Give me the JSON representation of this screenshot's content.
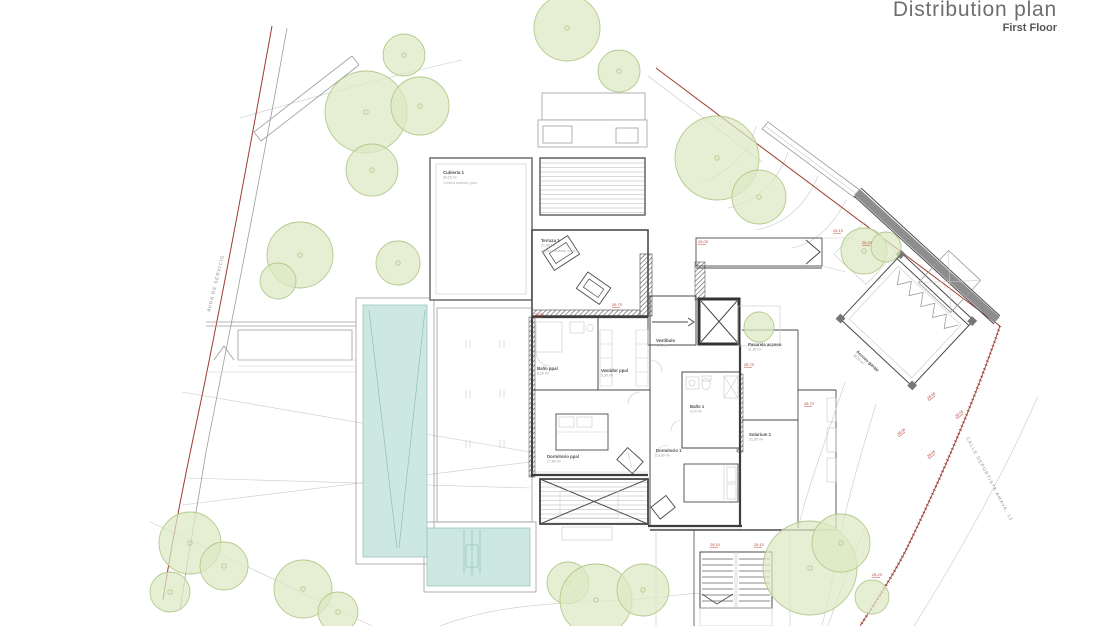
{
  "header": {
    "title": "Distribution plan",
    "subtitle": "First Floor"
  },
  "streets": {
    "left": "AVDA DE SERVICIO",
    "right": "CALLE DEPORTISTA AMAYA, 12"
  },
  "colors": {
    "pool": "#cde8e2",
    "pool_line": "#93bfb5",
    "tree_fill": "#dde9c3",
    "tree_stroke": "#b5c98b",
    "boundary_red": "#9c3b2e",
    "level_red": "#b5443a",
    "wall_dark": "#3d3d3d",
    "label": "#5a5a5a"
  },
  "rooms": [
    {
      "id": "cubierta",
      "name": "Cubierta 1",
      "area": "30,15 m²",
      "note": "Cubierta acabado grava",
      "x": 443,
      "y": 174
    },
    {
      "id": "terraza",
      "name": "Terraza 1",
      "area": "21,40 m²",
      "note": "Cubierta acabado madera",
      "x": 541,
      "y": 242
    },
    {
      "id": "banoppal",
      "name": "Baño ppal",
      "area": "6,20 m²",
      "x": 537,
      "y": 370
    },
    {
      "id": "vestidor",
      "name": "Vestidor ppal",
      "area": "5,30 m²",
      "x": 601,
      "y": 372
    },
    {
      "id": "vestibulo",
      "name": "Vestíbulo",
      "area": "4,90 m²",
      "x": 656,
      "y": 342
    },
    {
      "id": "dormppal",
      "name": "Dormitorio ppal",
      "area": "17,60 m²",
      "x": 547,
      "y": 458
    },
    {
      "id": "dorm1",
      "name": "Dormitorio 1",
      "area": "13,90 m²",
      "x": 656,
      "y": 452
    },
    {
      "id": "bano1",
      "name": "Baño 1",
      "area": "4,10 m²",
      "x": 690,
      "y": 408
    },
    {
      "id": "pasarela",
      "name": "Pasarela acceso",
      "area": "11,20 m²",
      "x": 748,
      "y": 346
    },
    {
      "id": "solarium",
      "name": "Solarium 1",
      "area": "21,30 m²",
      "x": 749,
      "y": 436
    },
    {
      "id": "garaje",
      "name": "Acceso garaje",
      "area": "36,50 m²",
      "x": 856,
      "y": 352,
      "rotate": 43
    }
  ],
  "levels": [
    {
      "value": "28.80",
      "x": 534,
      "y": 316
    },
    {
      "value": "28.75",
      "x": 612,
      "y": 306
    },
    {
      "value": "29.05",
      "x": 698,
      "y": 243
    },
    {
      "value": "29.15",
      "x": 833,
      "y": 232
    },
    {
      "value": "29.20",
      "x": 862,
      "y": 244
    },
    {
      "value": "28.75",
      "x": 744,
      "y": 366
    },
    {
      "value": "28.70",
      "x": 804,
      "y": 405
    },
    {
      "value": "28.60",
      "x": 928,
      "y": 400,
      "rotate": -38
    },
    {
      "value": "28.55",
      "x": 956,
      "y": 418,
      "rotate": -38
    },
    {
      "value": "28.50",
      "x": 898,
      "y": 436,
      "rotate": -38
    },
    {
      "value": "28.45",
      "x": 928,
      "y": 458,
      "rotate": -38
    },
    {
      "value": "29.10",
      "x": 710,
      "y": 546
    },
    {
      "value": "29.10",
      "x": 754,
      "y": 546
    },
    {
      "value": "28.25",
      "x": 872,
      "y": 576
    }
  ],
  "trees": [
    {
      "x": 404,
      "y": 55,
      "r": 21
    },
    {
      "x": 366,
      "y": 112,
      "r": 41
    },
    {
      "x": 420,
      "y": 106,
      "r": 29
    },
    {
      "x": 372,
      "y": 170,
      "r": 26
    },
    {
      "x": 300,
      "y": 255,
      "r": 33
    },
    {
      "x": 278,
      "y": 281,
      "r": 18
    },
    {
      "x": 398,
      "y": 263,
      "r": 22
    },
    {
      "x": 567,
      "y": 28,
      "r": 33
    },
    {
      "x": 619,
      "y": 71,
      "r": 21
    },
    {
      "x": 717,
      "y": 158,
      "r": 42
    },
    {
      "x": 759,
      "y": 197,
      "r": 27
    },
    {
      "x": 864,
      "y": 251,
      "r": 23
    },
    {
      "x": 886,
      "y": 247,
      "r": 15
    },
    {
      "x": 759,
      "y": 327,
      "r": 15
    },
    {
      "x": 190,
      "y": 543,
      "r": 31
    },
    {
      "x": 224,
      "y": 566,
      "r": 24
    },
    {
      "x": 170,
      "y": 592,
      "r": 20
    },
    {
      "x": 303,
      "y": 589,
      "r": 29
    },
    {
      "x": 338,
      "y": 612,
      "r": 20
    },
    {
      "x": 568,
      "y": 583,
      "r": 21
    },
    {
      "x": 596,
      "y": 600,
      "r": 36
    },
    {
      "x": 643,
      "y": 590,
      "r": 26
    },
    {
      "x": 810,
      "y": 568,
      "r": 47
    },
    {
      "x": 841,
      "y": 543,
      "r": 29
    },
    {
      "x": 872,
      "y": 597,
      "r": 17
    }
  ]
}
